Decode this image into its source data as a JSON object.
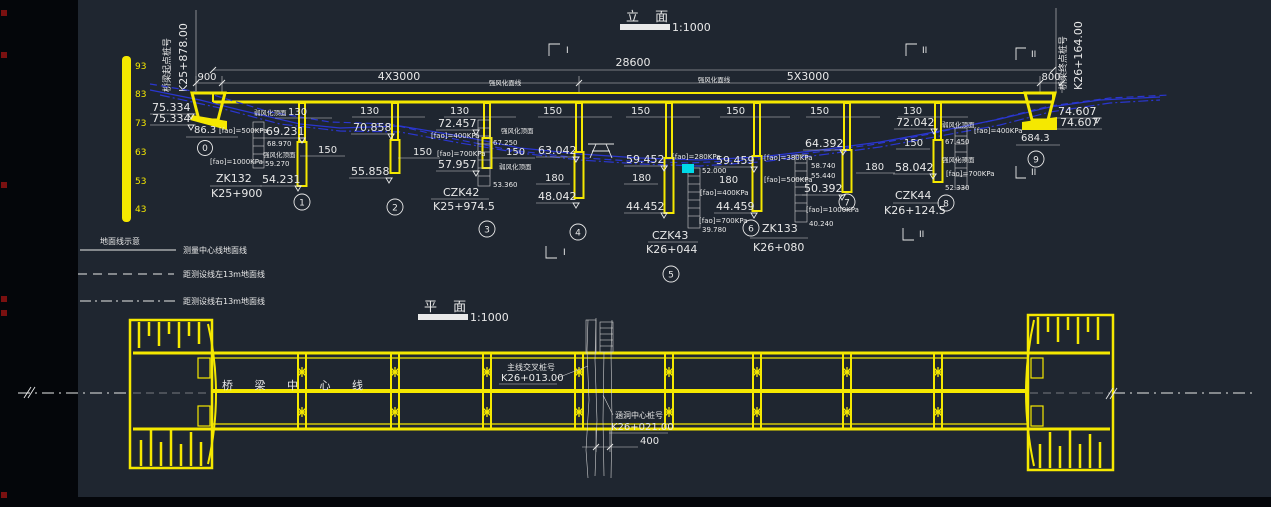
{
  "colors": {
    "background": "#1f2630",
    "line_yellow": "#f5e800",
    "line_white": "#e9e9e9",
    "ground_blue": "#2a36cf",
    "highlight_cyan": "#00d9e8",
    "grip_red": "#7a1010"
  },
  "elevation": {
    "title": "立  面",
    "scale": "1:1000",
    "total_dim": "28600",
    "dim_left_overhang": "900",
    "dim_left_spans": "4X3000",
    "dim_right_spans": "5X3000",
    "dim_right_overhang": "800",
    "start_label": "桥梁起点桩号",
    "start_chainage": "K25+878.00",
    "end_label": "桥梁终点桩号",
    "end_chainage": "K26+164.00",
    "scale_ticks": [
      "93",
      "83",
      "73",
      "63",
      "53",
      "43"
    ],
    "weathered_label": "强风化面线",
    "sections": {
      "i": "I",
      "ii": "II"
    },
    "left_abutment": {
      "number": "0",
      "deck_elev_top": "75.334",
      "deck_elev_bottom": "75.334",
      "width_dim": "86.3",
      "fao_upper": "[fao]=500KPa",
      "fao_lower": "[fao]=1000KPa",
      "borehole_name": "ZK132",
      "borehole_chainage": "K25+900"
    },
    "right_abutment": {
      "number": "9",
      "deck_elev_top": "74.607",
      "deck_elev_bottom": "74.607",
      "width_dim": "684.3"
    },
    "piers": [
      {
        "number": "1",
        "column_dia": "130",
        "pile_dia": "150",
        "column_top_elev": "69.231",
        "pile_tip_elev": "54.231",
        "stratum_upper_label": "弱风化顶面",
        "stratum_upper_elev": "68.970",
        "stratum_lower_label": "强风化顶面",
        "stratum_lower_elev": "59.270"
      },
      {
        "number": "2",
        "column_dia": "130",
        "pile_dia": "150",
        "column_top_elev": "70.858",
        "pile_tip_elev": "55.858"
      },
      {
        "number": "3",
        "column_dia": "130",
        "pile_dia": "150",
        "column_top_elev": "72.457",
        "pile_tip_elev": "57.957",
        "fao_upper": "[fao]=400KPa",
        "fao_lower": "[fao]=700KPa",
        "stratum_upper_label": "强风化顶面",
        "stratum_upper_elev": "67.250",
        "stratum_lower_label": "弱风化顶面",
        "stratum_lower_elev": "53.360",
        "borehole_name": "CZK42",
        "borehole_chainage": "K25+974.5"
      },
      {
        "number": "4",
        "column_dia": "150",
        "pile_dia": "180",
        "column_top_elev": "63.042",
        "pile_tip_elev": "48.042"
      },
      {
        "number": "5",
        "column_dia": "150",
        "pile_dia": "180",
        "column_top_elev": "59.452",
        "pile_tip_elev": "44.452",
        "borehole_name": "CZK43",
        "borehole_chainage": "K26+044"
      },
      {
        "number": "6",
        "column_dia": "150",
        "pile_dia": "180",
        "column_top_elev": "59.459",
        "pile_tip_elev": "44.459",
        "fao_a": "[fao]=280KPa",
        "level_a": "52.000",
        "fao_b": "[fao]=400KPa",
        "fao_c": "[fao]=700KPa",
        "level_b": "39.780",
        "fao_d": "[fao]=380KPa",
        "fao_e": "[fao]=500KPa",
        "borehole_name": "ZK133",
        "borehole_chainage": "K26+080"
      },
      {
        "number": "7",
        "column_dia": "150",
        "pile_dia": "180",
        "column_top_elev": "64.392",
        "pile_tip_elev": "50.392",
        "level_a": "58.740",
        "level_b": "55.440",
        "fao_a": "[fao]=1000KPa",
        "level_c": "40.240"
      },
      {
        "number": "8",
        "column_dia": "130",
        "pile_dia": "150",
        "column_top_elev": "72.042",
        "pile_tip_elev": "58.042",
        "stratum_upper_label": "弱风化顶面",
        "stratum_upper_fao": "[fao]=400KPa",
        "stratum_upper_elev": "67.450",
        "stratum_lower_label": "强风化顶面",
        "stratum_lower_fao": "[fao]=700KPa",
        "stratum_lower_elev": "52.330",
        "borehole_name": "CZK44",
        "borehole_chainage": "K26+124.5"
      }
    ],
    "legend": {
      "title": "地面线示意",
      "solid_label": "测量中心线地面线",
      "dashed_label": "距测设线左13m地面线",
      "dashdot_label": "距测设线右13m地面线"
    }
  },
  "plan": {
    "title": "平  面",
    "scale": "1:1000",
    "centerline_label": "桥 梁 中 心 线",
    "main_cross_label": "主线交叉桩号",
    "main_cross_chainage": "K26+013.00",
    "culvert_label": "涵洞中心桩号",
    "culvert_chainage": "K26+021.00",
    "culvert_width_dim": "400"
  }
}
